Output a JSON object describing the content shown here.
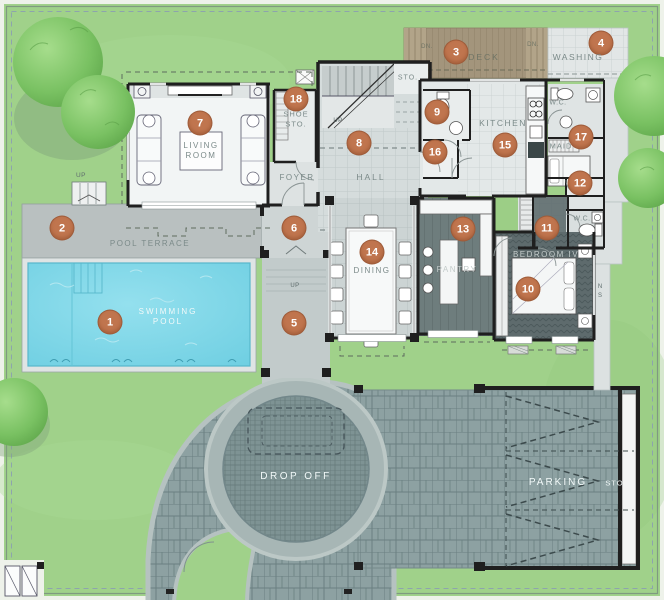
{
  "markers": {
    "m1": "1",
    "m2": "2",
    "m3": "3",
    "m4": "4",
    "m5": "5",
    "m6": "6",
    "m7": "7",
    "m8": "8",
    "m9": "9",
    "m10": "10",
    "m11": "11",
    "m12": "12",
    "m13": "13",
    "m14": "14",
    "m15": "15",
    "m16": "16",
    "m17": "17",
    "m18": "18"
  },
  "labels": {
    "swimming_line1": "SWIMMING",
    "swimming_line2": "POOL",
    "pool_terrace": "POOL TERRACE",
    "deck": "DECK",
    "washing": "WASHING",
    "living1": "LIVING",
    "living2": "ROOM",
    "shoe1": "SHOE",
    "shoe2": "STO.",
    "foyer": "FOYER",
    "hall": "HALL",
    "sto_stair": "STO.",
    "kitchen": "KITCHEN",
    "wc_a": "W.C.",
    "maid": "MAID",
    "wc_b": "W.C.",
    "bedroom": "BEDROOM IV",
    "pantry": "PANTRY",
    "dining": "DINING",
    "drop_off": "DROP OFF",
    "parking": "PARKING",
    "sto_parking": "STO.",
    "dn_a": "DN.",
    "dn_b": "DN.",
    "up_a": "UP",
    "up_b": "UP",
    "up_c": "UP",
    "ns_n": "N",
    "ns_s": "S"
  },
  "colors": {
    "accent": "#c0754e",
    "grass": "#a0d18a",
    "water": "#7fd7e7",
    "paver": "#8da1a2",
    "deck_wood": "#a3957c",
    "wall": "#1f1f1f",
    "label_gray": "#7b8a89"
  }
}
